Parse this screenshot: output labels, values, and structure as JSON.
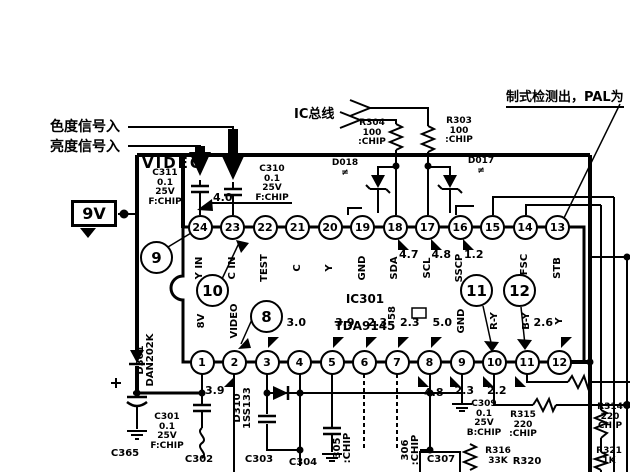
{
  "annotations": {
    "chroma_in": "色度信号入",
    "luma_in": "亮度信号入",
    "ic_bus": "IC总线",
    "standard_detect": "制式检测出，PAL为",
    "supply": "9V",
    "module": "VIDEO"
  },
  "ic": {
    "ref": "IC301",
    "part": "TDA9145",
    "top_pins": [
      {
        "n": "24",
        "label": "Y IN",
        "v": ""
      },
      {
        "n": "23",
        "label": "C IN",
        "v": ""
      },
      {
        "n": "22",
        "label": "TEST",
        "v": ""
      },
      {
        "n": "21",
        "label": "C",
        "v": ""
      },
      {
        "n": "20",
        "label": "Y",
        "v": ""
      },
      {
        "n": "19",
        "label": "GND",
        "v": ""
      },
      {
        "n": "18",
        "label": "SDA",
        "v": "4.7"
      },
      {
        "n": "17",
        "label": "SCL",
        "v": "4.8"
      },
      {
        "n": "16",
        "label": "SSCP",
        "v": "1.2"
      },
      {
        "n": "15",
        "label": "",
        "v": ""
      },
      {
        "n": "14",
        "label": "2FSC",
        "v": ""
      },
      {
        "n": "13",
        "label": "STB",
        "v": ""
      }
    ],
    "bottom_pins": [
      {
        "n": "1",
        "label": "8V",
        "v": "",
        "v2": ""
      },
      {
        "n": "2",
        "label": "VIDEO",
        "v": "",
        "v2": ""
      },
      {
        "n": "3",
        "label": "",
        "v": "",
        "v2": ""
      },
      {
        "n": "4",
        "label": "",
        "v": "3.0",
        "v2": ""
      },
      {
        "n": "5",
        "label": "",
        "v": "3.9",
        "v2": ""
      },
      {
        "n": "6",
        "label": "",
        "v": "2.3",
        "v2": ""
      },
      {
        "n": "7",
        "label": "",
        "v": "2.3",
        "v2": ""
      },
      {
        "n": "8",
        "label": "",
        "v": "5.0",
        "v2": ""
      },
      {
        "n": "9",
        "label": "GND",
        "v": "",
        "v2": ""
      },
      {
        "n": "10",
        "label": "R-Y",
        "v": "",
        "v2": "2.3"
      },
      {
        "n": "11",
        "label": "B-Y",
        "v": "",
        "v2": "2.2"
      },
      {
        "n": "12",
        "label": "Y",
        "v": "2.6",
        "v2": ""
      }
    ]
  },
  "test_points": {
    "tp8": "8",
    "tp9": "9",
    "tp10": "10",
    "tp11": "11",
    "tp12": "12"
  },
  "voltages": {
    "pin24": "4.0",
    "pin2_net": "3.9",
    "net_48": "4.8"
  },
  "components": {
    "c311": "C311\n0.1\n25V\nF:CHIP",
    "c310": "C310\n0.1\n25V\nF:CHIP",
    "r304": "R304\n100\n:CHIP",
    "r303": "R303\n100\n:CHIP",
    "d018": "D018\n≠",
    "d017": "D017\n≠",
    "d301": "D301\nDAN202K",
    "c301": "C301\n0.1\n25V\nF:CHIP",
    "c365": "C365",
    "c302": "C302",
    "c303": "C303",
    "c304": "C304",
    "d310": "D310\n1SS133",
    "c305": "305\n:CHIP",
    "c306": "306\n:CHIP",
    "c307": "C307",
    "c309": "C309\n0.1\n25V\nB:CHIP",
    "r315": "R315\n220\n:CHIP",
    "r314": "R314\n220\nCHIP",
    "r316": "R316\n33K",
    "r320": "R320",
    "r321": "R321\n1K",
    "x58": "58"
  }
}
